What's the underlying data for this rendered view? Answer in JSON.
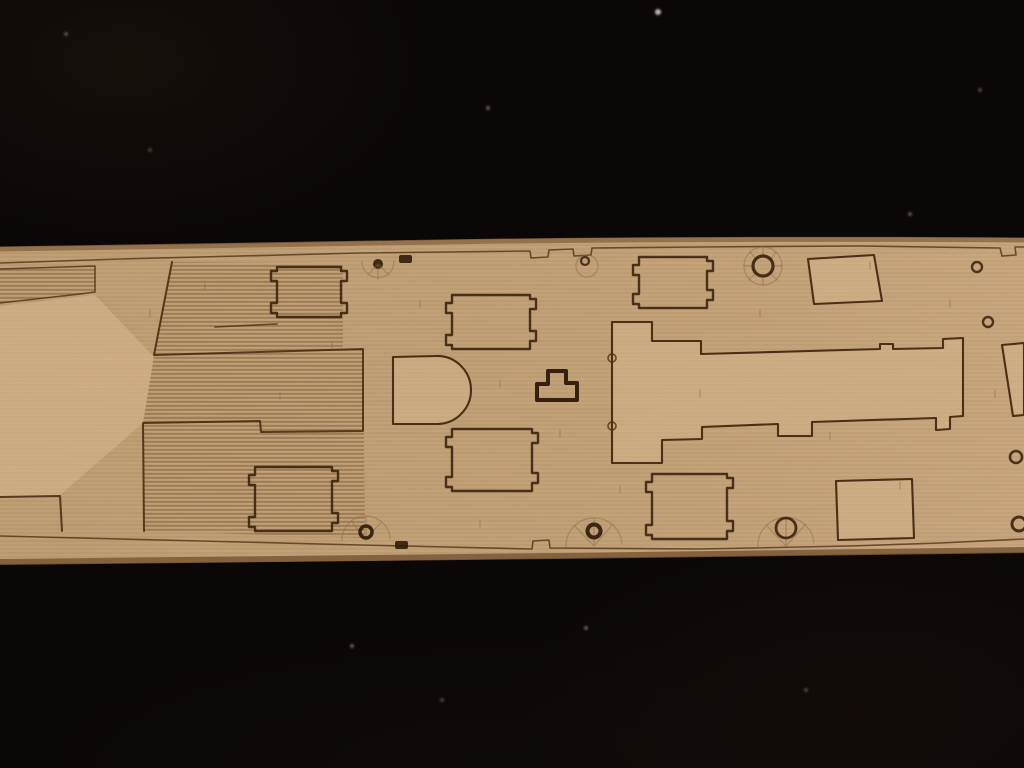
{
  "scene": {
    "subject": "laser-etched wooden model ship deck strip photographed on black felt",
    "background_color": "#0b0706",
    "wood_color": "#c7a67c",
    "etch_line_color": "#3f2309",
    "burnt_edge_color": "#7a5836",
    "visible_text": ""
  },
  "svg": {
    "viewBox": "0 0 1024 768",
    "shapes": [
      {
        "name": "wood-strip-base",
        "tag": "path",
        "attrs": {
          "d": "M0,247 Q250,244 440,240 Q700,236 1024,238 L1024,552 Q800,555 560,558 Q300,562 0,564 Z",
          "fill": "#c7a67c"
        }
      },
      {
        "name": "wood-grain-texture",
        "tag": "rect",
        "attrs": {
          "x": "0",
          "y": "234",
          "width": "1024",
          "height": "334",
          "fill": "url(#grainLines)",
          "clip-path": "url(#woodClip)"
        }
      },
      {
        "name": "wood-noise-texture",
        "tag": "rect",
        "attrs": {
          "x": "0",
          "y": "234",
          "width": "1024",
          "height": "334",
          "fill": "#b08a5e",
          "filter": "url(#woodNoise)",
          "clip-path": "url(#woodClip)",
          "opacity": "0.5"
        }
      },
      {
        "name": "wood-right-light-sheen",
        "tag": "rect",
        "attrs": {
          "x": "0",
          "y": "234",
          "width": "1024",
          "height": "334",
          "fill": "url(#lrGrad)",
          "clip-path": "url(#woodClip)"
        }
      },
      {
        "name": "left-smooth-zone",
        "tag": "path",
        "attrs": {
          "d": "M0,306 L95,295 L154,357 L143,423 L60,495 L0,497 Z",
          "class": "lightfill"
        }
      },
      {
        "name": "stripe-zone-forecastle-band",
        "tag": "path",
        "attrs": {
          "d": "M0,269 L95,266 L95,292 L80,294 L0,303 Z",
          "class": "stripes"
        }
      },
      {
        "name": "stripe-zone-mid-left",
        "tag": "path",
        "attrs": {
          "d": "M172,262 L154,355 L343,350 L343,263 Z",
          "class": "stripes"
        }
      },
      {
        "name": "stripe-zone-lower-left",
        "tag": "path",
        "attrs": {
          "d": "M154,355 L363,349 L365,538 L144,531 L143,423 Z",
          "class": "stripes"
        }
      },
      {
        "name": "burnt-edge-top",
        "tag": "path",
        "attrs": {
          "d": "M0,249 Q250,246 440,242 Q700,238 1024,240",
          "fill": "none",
          "stroke": "#8a6642",
          "stroke-width": "5",
          "opacity": "0.8"
        }
      },
      {
        "name": "burnt-edge-bottom",
        "tag": "path",
        "attrs": {
          "d": "M0,562 Q300,560 560,556 Q800,553 1024,550",
          "fill": "none",
          "stroke": "#7a5836",
          "stroke-width": "6",
          "opacity": "0.85"
        }
      },
      {
        "name": "deck-margin-line-top",
        "tag": "path",
        "attrs": {
          "d": "M0,263 L120,259 L360,253 L530,251 L531,258 L548,257 L549,250 L573,249 L574,256 L591,255 L592,248 L700,247 L860,246 L1000,248 L1002,256 L1016,255 L1015,247 L1024,247",
          "class": "margin-line"
        }
      },
      {
        "name": "deck-margin-line-bottom",
        "tag": "path",
        "attrs": {
          "d": "M0,536 L200,541 L360,545 L532,549 L533,541 L549,540 L550,548 L700,549 L850,546 L940,543 L1024,539",
          "class": "margin-line"
        }
      },
      {
        "name": "forecastle-band-outline",
        "tag": "path",
        "attrs": {
          "d": "M0,269 L95,266 L95,292 L80,294 L0,303",
          "class": "etch16"
        }
      },
      {
        "name": "left-deckhouse-outline",
        "tag": "path",
        "attrs": {
          "d": "M172,262 L154,355 L363,349 L363,431 L261,432 L260,421 L143,423 L144,531",
          "class": "etch"
        }
      },
      {
        "name": "bottom-left-band-outline",
        "tag": "path",
        "attrs": {
          "d": "M0,497 L60,496 L62,531",
          "class": "etch"
        }
      },
      {
        "name": "left-connector-line",
        "tag": "path",
        "attrs": {
          "d": "M215,327 L277,324",
          "class": "etch16"
        }
      },
      {
        "name": "hatch-upper-left-outline",
        "tag": "path",
        "attrs": {
          "d": "M277,267 H341 V271 h6 v10 h-6 V303 h6 v10 h-6 V317 H277 V313 h-6 v-10 h6 V281 h-6 v-10 h6 Z",
          "class": "etch22"
        }
      },
      {
        "name": "hatch-center-upper-outline",
        "tag": "path",
        "attrs": {
          "d": "M452,295 H530 V299 h6 v10 h-6 V331 h6 v10 h-6 V349 H452 V345 h-6 v-10 h6 V313 h-6 v-10 h6 Z",
          "class": "etch22"
        }
      },
      {
        "name": "hatch-center-lower-outline",
        "tag": "path",
        "attrs": {
          "d": "M452,429 H532 V433 h6 v10 h-6 V473 h6 v10 h-6 V491 H452 V487 h-6 v-10 h6 V447 h-6 v-10 h6 Z",
          "class": "etch22"
        }
      },
      {
        "name": "hatch-top-right-outline",
        "tag": "path",
        "attrs": {
          "d": "M639,257 H707 V261 h6 v10 h-6 V290 h6 v10 h-6 V308 H639 V304 h-6 v-10 h6 V275 h-6 v-10 h6 Z",
          "class": "etch22"
        }
      },
      {
        "name": "hatch-bottom-left-outline",
        "tag": "path",
        "attrs": {
          "d": "M255,467 H332 V471 h6 v10 h-6 V513 h6 v10 h-6 V531 H255 V527 h-6 v-10 h6 V485 h-6 v-10 h6 Z",
          "class": "etch22"
        }
      },
      {
        "name": "hatch-bottom-center-outline",
        "tag": "path",
        "attrs": {
          "d": "M652,474 H727 V478 h6 v10 h-6 V521 h6 v10 h-6 V539 H652 V535 h-6 v-10 h6 V492 h-6 v-10 h6 Z",
          "class": "etch22"
        }
      },
      {
        "name": "d-shaped-structure-outline",
        "tag": "path",
        "attrs": {
          "d": "M393,357 L436,356 A34,34 0 0 1 471,390 A34,34 0 0 1 436,424 L393,424 Z",
          "class": "combofill"
        }
      },
      {
        "name": "t-shaped-fitting-outline",
        "tag": "path",
        "attrs": {
          "d": "M548,371 H566 V383 H577 V400 H537 V384 H548 Z",
          "class": "etch-thick"
        }
      },
      {
        "name": "superstructure-outline",
        "tag": "path",
        "attrs": {
          "d": "M612,322 L652,322 L652,341 L701,341 L701,354 L880,349 L880,344 L893,344 L893,349 L943,348 L943,339 L963,338 L963,416 L950,417 L950,429 L936,430 L936,418 L812,422 L812,436 L778,436 L778,424 L702,427 L702,439 L662,440 L662,463 L612,463 Z",
          "class": "combofill"
        }
      },
      {
        "name": "superstructure-notch-upper",
        "tag": "circle",
        "attrs": {
          "cx": "612",
          "cy": "358",
          "r": "4",
          "class": "etch16"
        }
      },
      {
        "name": "superstructure-notch-lower",
        "tag": "circle",
        "attrs": {
          "cx": "612",
          "cy": "426",
          "r": "4",
          "class": "etch16"
        }
      },
      {
        "name": "skylight-square-top-outline",
        "tag": "path",
        "attrs": {
          "d": "M808,259 L874,255 L882,301 L814,304 Z",
          "class": "combofill"
        }
      },
      {
        "name": "right-deckhouse-outline",
        "tag": "path",
        "attrs": {
          "d": "M1024,343 L1002,345 L1013,416 L1024,415 Z",
          "class": "combofill"
        }
      },
      {
        "name": "skylight-square-bottom-outline",
        "tag": "path",
        "attrs": {
          "d": "M836,481 L912,479 L914,538 L838,540 Z",
          "class": "combofill"
        }
      },
      {
        "name": "capstan-fan-etching",
        "tag": "circle",
        "attrs": {
          "cx": "763",
          "cy": "266",
          "r": "19",
          "class": "faint"
        }
      },
      {
        "name": "capstan-fan-spokes",
        "tag": "path",
        "attrs": {
          "d": "M763,247 V255 M776,252 L771,259 M782,266 H774 M777,280 L771,274 M763,285 V277 M749,280 L755,274 M744,266 H752 M750,252 L756,259",
          "class": "faint"
        }
      },
      {
        "name": "capstan-ring",
        "tag": "circle",
        "attrs": {
          "cx": "763",
          "cy": "266",
          "r": "10",
          "fill": "none",
          "stroke": "#38200a",
          "stroke-width": "3.2",
          "opacity": "0.9"
        }
      },
      {
        "name": "mooring-ring-top-right",
        "tag": "circle",
        "attrs": {
          "cx": "977",
          "cy": "267",
          "r": "5",
          "fill": "none",
          "stroke": "#38200a",
          "stroke-width": "2.4",
          "opacity": "0.85"
        }
      },
      {
        "name": "mooring-ring-mid-right",
        "tag": "circle",
        "attrs": {
          "cx": "988",
          "cy": "322",
          "r": "5",
          "fill": "none",
          "stroke": "#38200a",
          "stroke-width": "2.4",
          "opacity": "0.85"
        }
      },
      {
        "name": "mooring-ring-lower-right",
        "tag": "circle",
        "attrs": {
          "cx": "1016",
          "cy": "457",
          "r": "6",
          "fill": "none",
          "stroke": "#38200a",
          "stroke-width": "2.6",
          "opacity": "0.85"
        }
      },
      {
        "name": "mooring-ring-bottom-right",
        "tag": "circle",
        "attrs": {
          "cx": "1019",
          "cy": "524",
          "r": "7",
          "fill": "none",
          "stroke": "#38200a",
          "stroke-width": "3",
          "opacity": "0.88"
        }
      },
      {
        "name": "small-ring-top-center",
        "tag": "circle",
        "attrs": {
          "cx": "585",
          "cy": "261",
          "r": "4",
          "fill": "none",
          "stroke": "#38200a",
          "stroke-width": "2.2",
          "opacity": "0.85"
        }
      },
      {
        "name": "small-fan-top-center",
        "tag": "circle",
        "attrs": {
          "cx": "587",
          "cy": "266",
          "r": "11",
          "class": "faint"
        }
      },
      {
        "name": "bollard-dot-top",
        "tag": "circle",
        "attrs": {
          "cx": "378",
          "cy": "264",
          "r": "5",
          "class": "darkfill"
        }
      },
      {
        "name": "fan-top-left-etching",
        "tag": "path",
        "attrs": {
          "d": "M362,262 A16,16 0 0 0 394,261 M378,264 L368,275 M378,264 L378,279 M378,264 L389,275",
          "class": "faint"
        }
      },
      {
        "name": "dark-fitting-top",
        "tag": "rect",
        "attrs": {
          "x": "399",
          "y": "255",
          "width": "13",
          "height": "8",
          "rx": "2",
          "class": "darkfill"
        }
      },
      {
        "name": "dark-fitting-bottom",
        "tag": "rect",
        "attrs": {
          "x": "395",
          "y": "541",
          "width": "13",
          "height": "8",
          "rx": "2",
          "class": "darkfill"
        }
      },
      {
        "name": "fan-bottom-left-etching",
        "tag": "path",
        "attrs": {
          "d": "M342,541 A24,24 0 0 1 390,539 M366,540 L352,522 M366,540 L366,516 M366,540 L381,522",
          "class": "faint"
        }
      },
      {
        "name": "bollard-dot-bottom-left",
        "tag": "circle",
        "attrs": {
          "cx": "366",
          "cy": "532",
          "r": "6",
          "fill": "none",
          "stroke": "#2e1a08",
          "stroke-width": "3.5",
          "opacity": "0.9"
        }
      },
      {
        "name": "fan-bottom-center-etching",
        "tag": "path",
        "attrs": {
          "d": "M566,548 A28,28 0 0 1 622,544 M594,546 L574,525 M594,546 L594,518 M594,546 L613,524",
          "class": "faint"
        }
      },
      {
        "name": "bollard-dot-bottom-center",
        "tag": "circle",
        "attrs": {
          "cx": "594",
          "cy": "531",
          "r": "6.5",
          "fill": "none",
          "stroke": "#2e1a08",
          "stroke-width": "4",
          "opacity": "0.9"
        }
      },
      {
        "name": "fan-bottom-right-etching",
        "tag": "path",
        "attrs": {
          "d": "M758,548 A28,28 0 0 1 814,543 M786,546 L766,525 M786,546 L786,518 M786,546 L806,524",
          "class": "faint"
        }
      },
      {
        "name": "ring-bottom-right-fan",
        "tag": "circle",
        "attrs": {
          "cx": "786",
          "cy": "528",
          "r": "10",
          "fill": "none",
          "stroke": "#38200a",
          "stroke-width": "2.8",
          "opacity": "0.88"
        }
      },
      {
        "name": "plank-butt-ticks",
        "tag": "path",
        "attrs": {
          "d": "M150,310 v7 M205,282 v7 M332,342 v7 M420,300 v7 M500,380 v7 M560,430 v7 M620,486 v7 M700,390 v7 M760,310 v7 M830,432 v7 M900,482 v7 M950,300 v7 M480,520 v7 M280,392 v7 M870,262 v7 M995,390 v7",
          "class": "faint",
          "opacity": "0.45"
        }
      }
    ]
  },
  "specks": [
    {
      "x": 658,
      "y": 12,
      "r": 3,
      "o": 0.9
    },
    {
      "x": 488,
      "y": 108,
      "r": 2,
      "o": 0.45
    },
    {
      "x": 910,
      "y": 214,
      "r": 2,
      "o": 0.4
    },
    {
      "x": 66,
      "y": 34,
      "r": 2,
      "o": 0.35
    },
    {
      "x": 352,
      "y": 646,
      "r": 2,
      "o": 0.45
    },
    {
      "x": 586,
      "y": 628,
      "r": 2,
      "o": 0.45
    },
    {
      "x": 442,
      "y": 700,
      "r": 2,
      "o": 0.3
    },
    {
      "x": 806,
      "y": 690,
      "r": 2,
      "o": 0.3
    },
    {
      "x": 150,
      "y": 150,
      "r": 2,
      "o": 0.28
    },
    {
      "x": 980,
      "y": 90,
      "r": 2,
      "o": 0.32
    }
  ]
}
